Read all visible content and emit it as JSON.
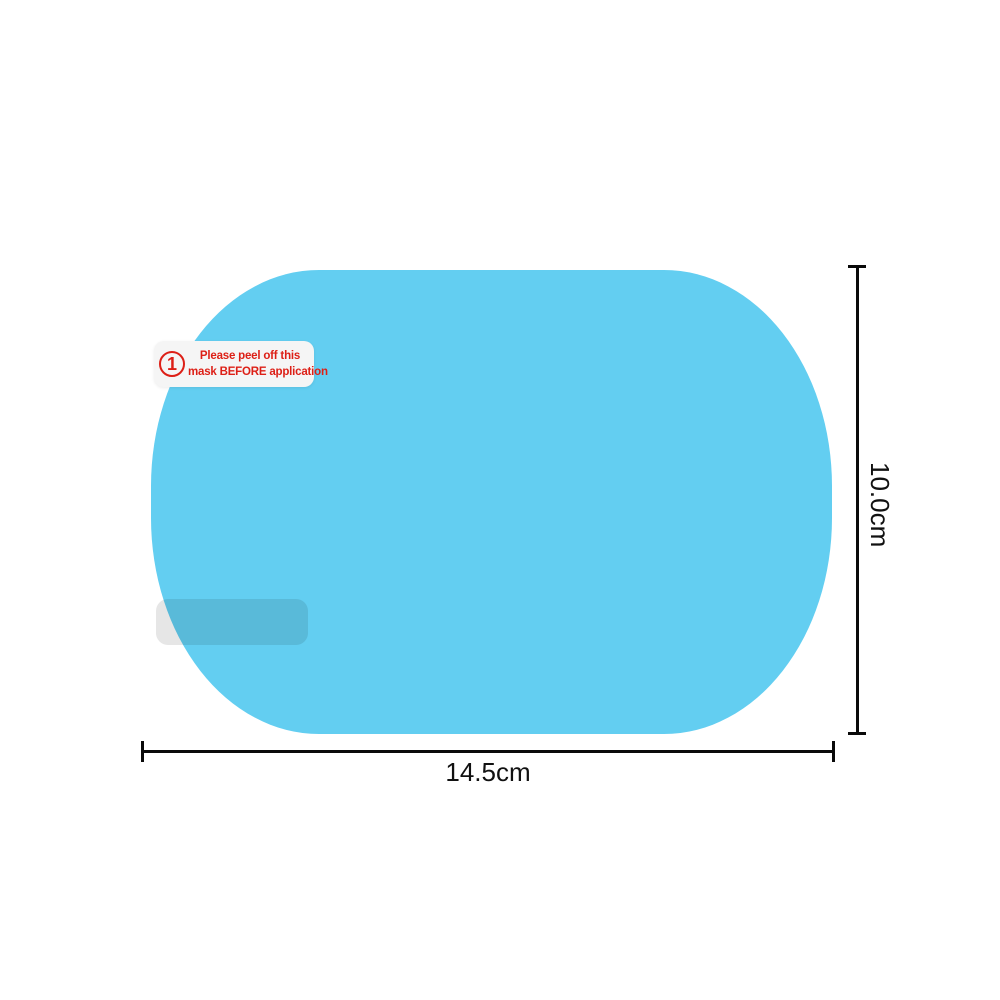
{
  "product": {
    "shape_name": "rainproof-mirror-film",
    "film_color": "#63cef1",
    "tab_color": "#e6e6e6"
  },
  "warning_label": {
    "step_number": "1",
    "line1": "Please peel off this",
    "line2": "mask BEFORE application",
    "text_color": "#dd1f16",
    "background": "#f5f5f5"
  },
  "dimensions": {
    "width_label": "14.5cm",
    "height_label": "10.0cm",
    "line_color": "#0a0a0a"
  }
}
